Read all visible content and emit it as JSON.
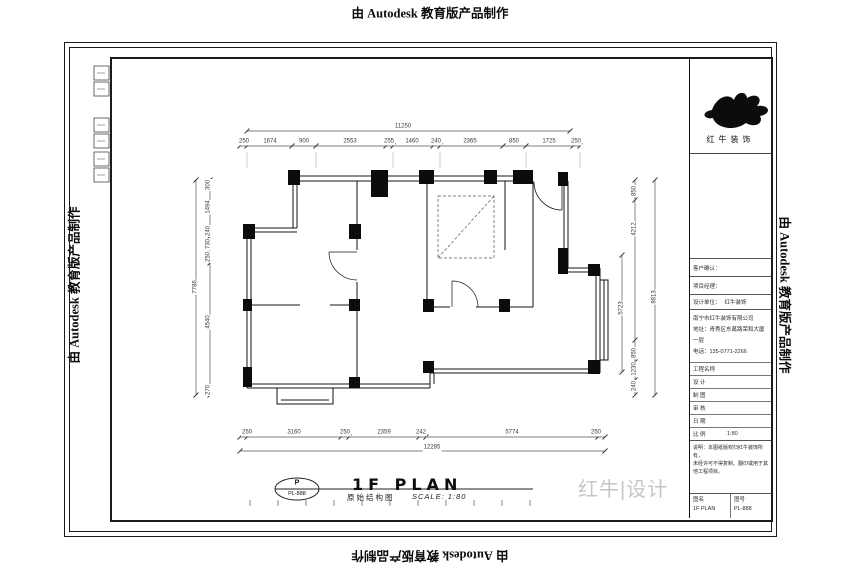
{
  "watermark": {
    "text": "由 Autodesk 教育版产品制作"
  },
  "brand": {
    "logo_text": "红牛装饰",
    "gray_watermark": "红牛|设计"
  },
  "plan": {
    "title": "1F PLAN",
    "subtitle_cn": "原始结构图",
    "scale_label": "SCALE: 1:80",
    "tag_letter": "P",
    "tag_code": "PL-888",
    "dims": {
      "top_total": "11250",
      "top_segments": [
        "250",
        "1674",
        "900",
        "2553",
        "255",
        "1460",
        "240",
        "2365",
        "850",
        "1725",
        "250"
      ],
      "bottom_total": "12285",
      "bottom_segments": [
        "250",
        "3160",
        "250",
        "2359",
        "242",
        "5774",
        "250"
      ],
      "left_total": "7786",
      "left_segments": [
        "300",
        "1494",
        "240",
        "730",
        "250",
        "4540",
        "270"
      ],
      "right_total": "8813",
      "right_segments": [
        "850",
        "4212",
        "5723",
        "850",
        "1230",
        "240"
      ]
    }
  },
  "titleblock": {
    "sign_rows": [
      {
        "label": "客户确认：",
        "value": ""
      },
      {
        "label": "项目经理：",
        "value": ""
      }
    ],
    "unit_row": {
      "label": "设计单位：",
      "value": "红牛装饰"
    },
    "company": [
      "南宁市红牛装饰有限公司",
      "地址：青秀区东葛路荣和大厦一层",
      "电话：135-0771-2266"
    ],
    "table": [
      {
        "label": "工程名称",
        "value": ""
      },
      {
        "label": "设  计",
        "value": ""
      },
      {
        "label": "制  图",
        "value": ""
      },
      {
        "label": "审  核",
        "value": ""
      },
      {
        "label": "日  期",
        "value": ""
      },
      {
        "label": "比  例",
        "value": "1:80"
      }
    ],
    "notes": [
      "说明：本图纸版权归红牛装饰所有，",
      "未经许可不得复制、翻印或用于其",
      "他工程项目。"
    ],
    "bottom": {
      "name_label": "图名",
      "name_value": "1F PLAN",
      "no_label": "图号",
      "no_value": "PL-888"
    }
  }
}
